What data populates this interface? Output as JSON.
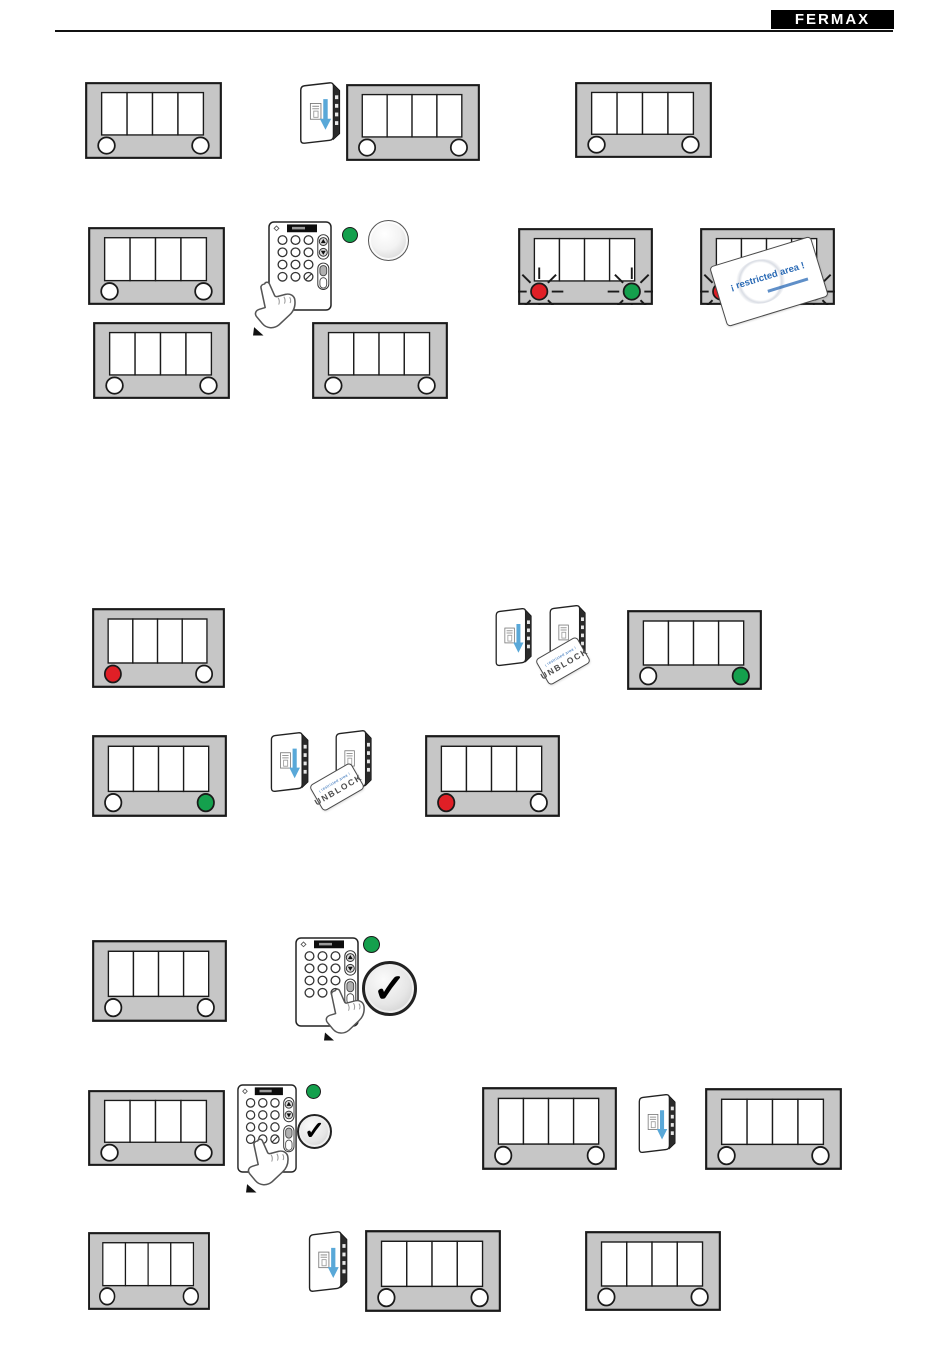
{
  "header": {
    "logo_text": "FERMAX"
  },
  "cards": {
    "restricted_area": {
      "text": "¡ restricted area !",
      "text_color": "#2a6ab5"
    },
    "unblock": {
      "small_print": "¡ restricted area !",
      "text": "UNBLOCK"
    }
  },
  "indicators": {
    "check_symbol": "✓",
    "led_red": "#e01f26",
    "led_green": "#14a04d",
    "led_off": "#ffffff",
    "blinking_marker": "rays"
  },
  "palette": {
    "panel_gray": "#c6c6c6",
    "outline_black": "#1a1a1a",
    "reader_arrow_blue": "#59a8d8",
    "logo_bg": "#000000",
    "logo_fg": "#ffffff"
  },
  "figures": {
    "display_panels": [
      {
        "id": 1,
        "row": 1,
        "leds": [
          "off",
          "off"
        ],
        "blinking": false
      },
      {
        "id": 2,
        "row": 1,
        "leds": [
          "off",
          "off"
        ],
        "blinking": false
      },
      {
        "id": 3,
        "row": 1,
        "leds": [
          "off",
          "off"
        ],
        "blinking": false
      },
      {
        "id": 4,
        "row": 2,
        "leds": [
          "off",
          "off"
        ],
        "blinking": false
      },
      {
        "id": 5,
        "row": 2,
        "leds": [
          "red",
          "green"
        ],
        "blinking": true
      },
      {
        "id": 6,
        "row": 2,
        "leds": [
          "red",
          "green"
        ],
        "blinking": true,
        "overlay": "restricted-area-card"
      },
      {
        "id": 7,
        "row": 3,
        "leds": [
          "off",
          "off"
        ],
        "blinking": false
      },
      {
        "id": 8,
        "row": 3,
        "leds": [
          "off",
          "off"
        ],
        "blinking": false
      },
      {
        "id": 9,
        "row": 4,
        "leds": [
          "red",
          "off"
        ],
        "blinking": false
      },
      {
        "id": 10,
        "row": 4,
        "leds": [
          "off",
          "green"
        ],
        "blinking": false
      },
      {
        "id": 11,
        "row": 5,
        "leds": [
          "off",
          "green"
        ],
        "blinking": false
      },
      {
        "id": 12,
        "row": 5,
        "leds": [
          "red",
          "off"
        ],
        "blinking": false
      },
      {
        "id": 13,
        "row": 6,
        "leds": [
          "off",
          "off"
        ],
        "blinking": false
      },
      {
        "id": 14,
        "row": 7,
        "leds": [
          "off",
          "off"
        ],
        "blinking": false
      },
      {
        "id": 15,
        "row": 7,
        "leds": [
          "off",
          "off"
        ],
        "blinking": false
      },
      {
        "id": 16,
        "row": 7,
        "leds": [
          "off",
          "off"
        ],
        "blinking": false
      },
      {
        "id": 17,
        "row": 8,
        "leds": [
          "off",
          "off"
        ],
        "blinking": false
      },
      {
        "id": 18,
        "row": 8,
        "leds": [
          "off",
          "off"
        ],
        "blinking": false
      },
      {
        "id": 19,
        "row": 8,
        "leds": [
          "off",
          "off"
        ],
        "blinking": false
      }
    ],
    "card_readers": 7,
    "keypads": 3,
    "pointing_hands": 3,
    "green_indicator_dots": 3,
    "lamp_buttons": 1,
    "check_buttons": 2,
    "unblock_cards": 2,
    "restricted_area_cards": 1
  }
}
